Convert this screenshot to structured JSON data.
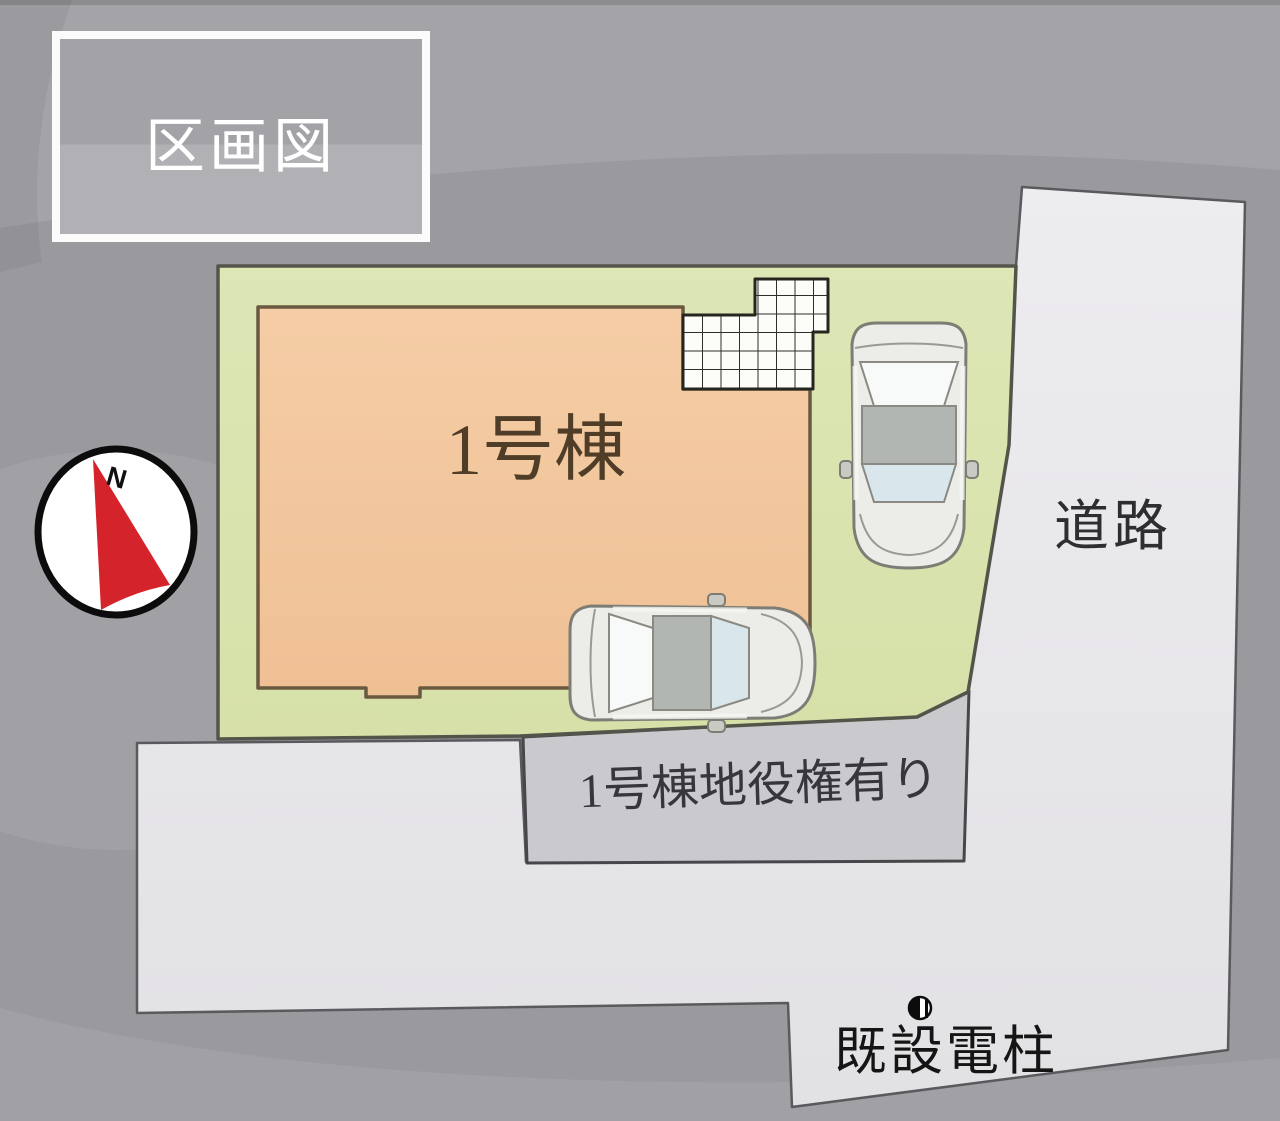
{
  "title_box": {
    "label": "区画図"
  },
  "compass": {
    "north_label": "N",
    "needle_color": "#d5232b"
  },
  "site": {
    "plot_fill": "#d9e3ad",
    "building": {
      "label": "1号棟",
      "fill": "#f3c89e"
    },
    "easement": {
      "label": "1号棟地役権有り",
      "fill": "#cac9cd"
    },
    "road": {
      "label": "道路"
    },
    "utility_pole": {
      "label": "既設電柱"
    },
    "parked_cars_count": 2
  }
}
